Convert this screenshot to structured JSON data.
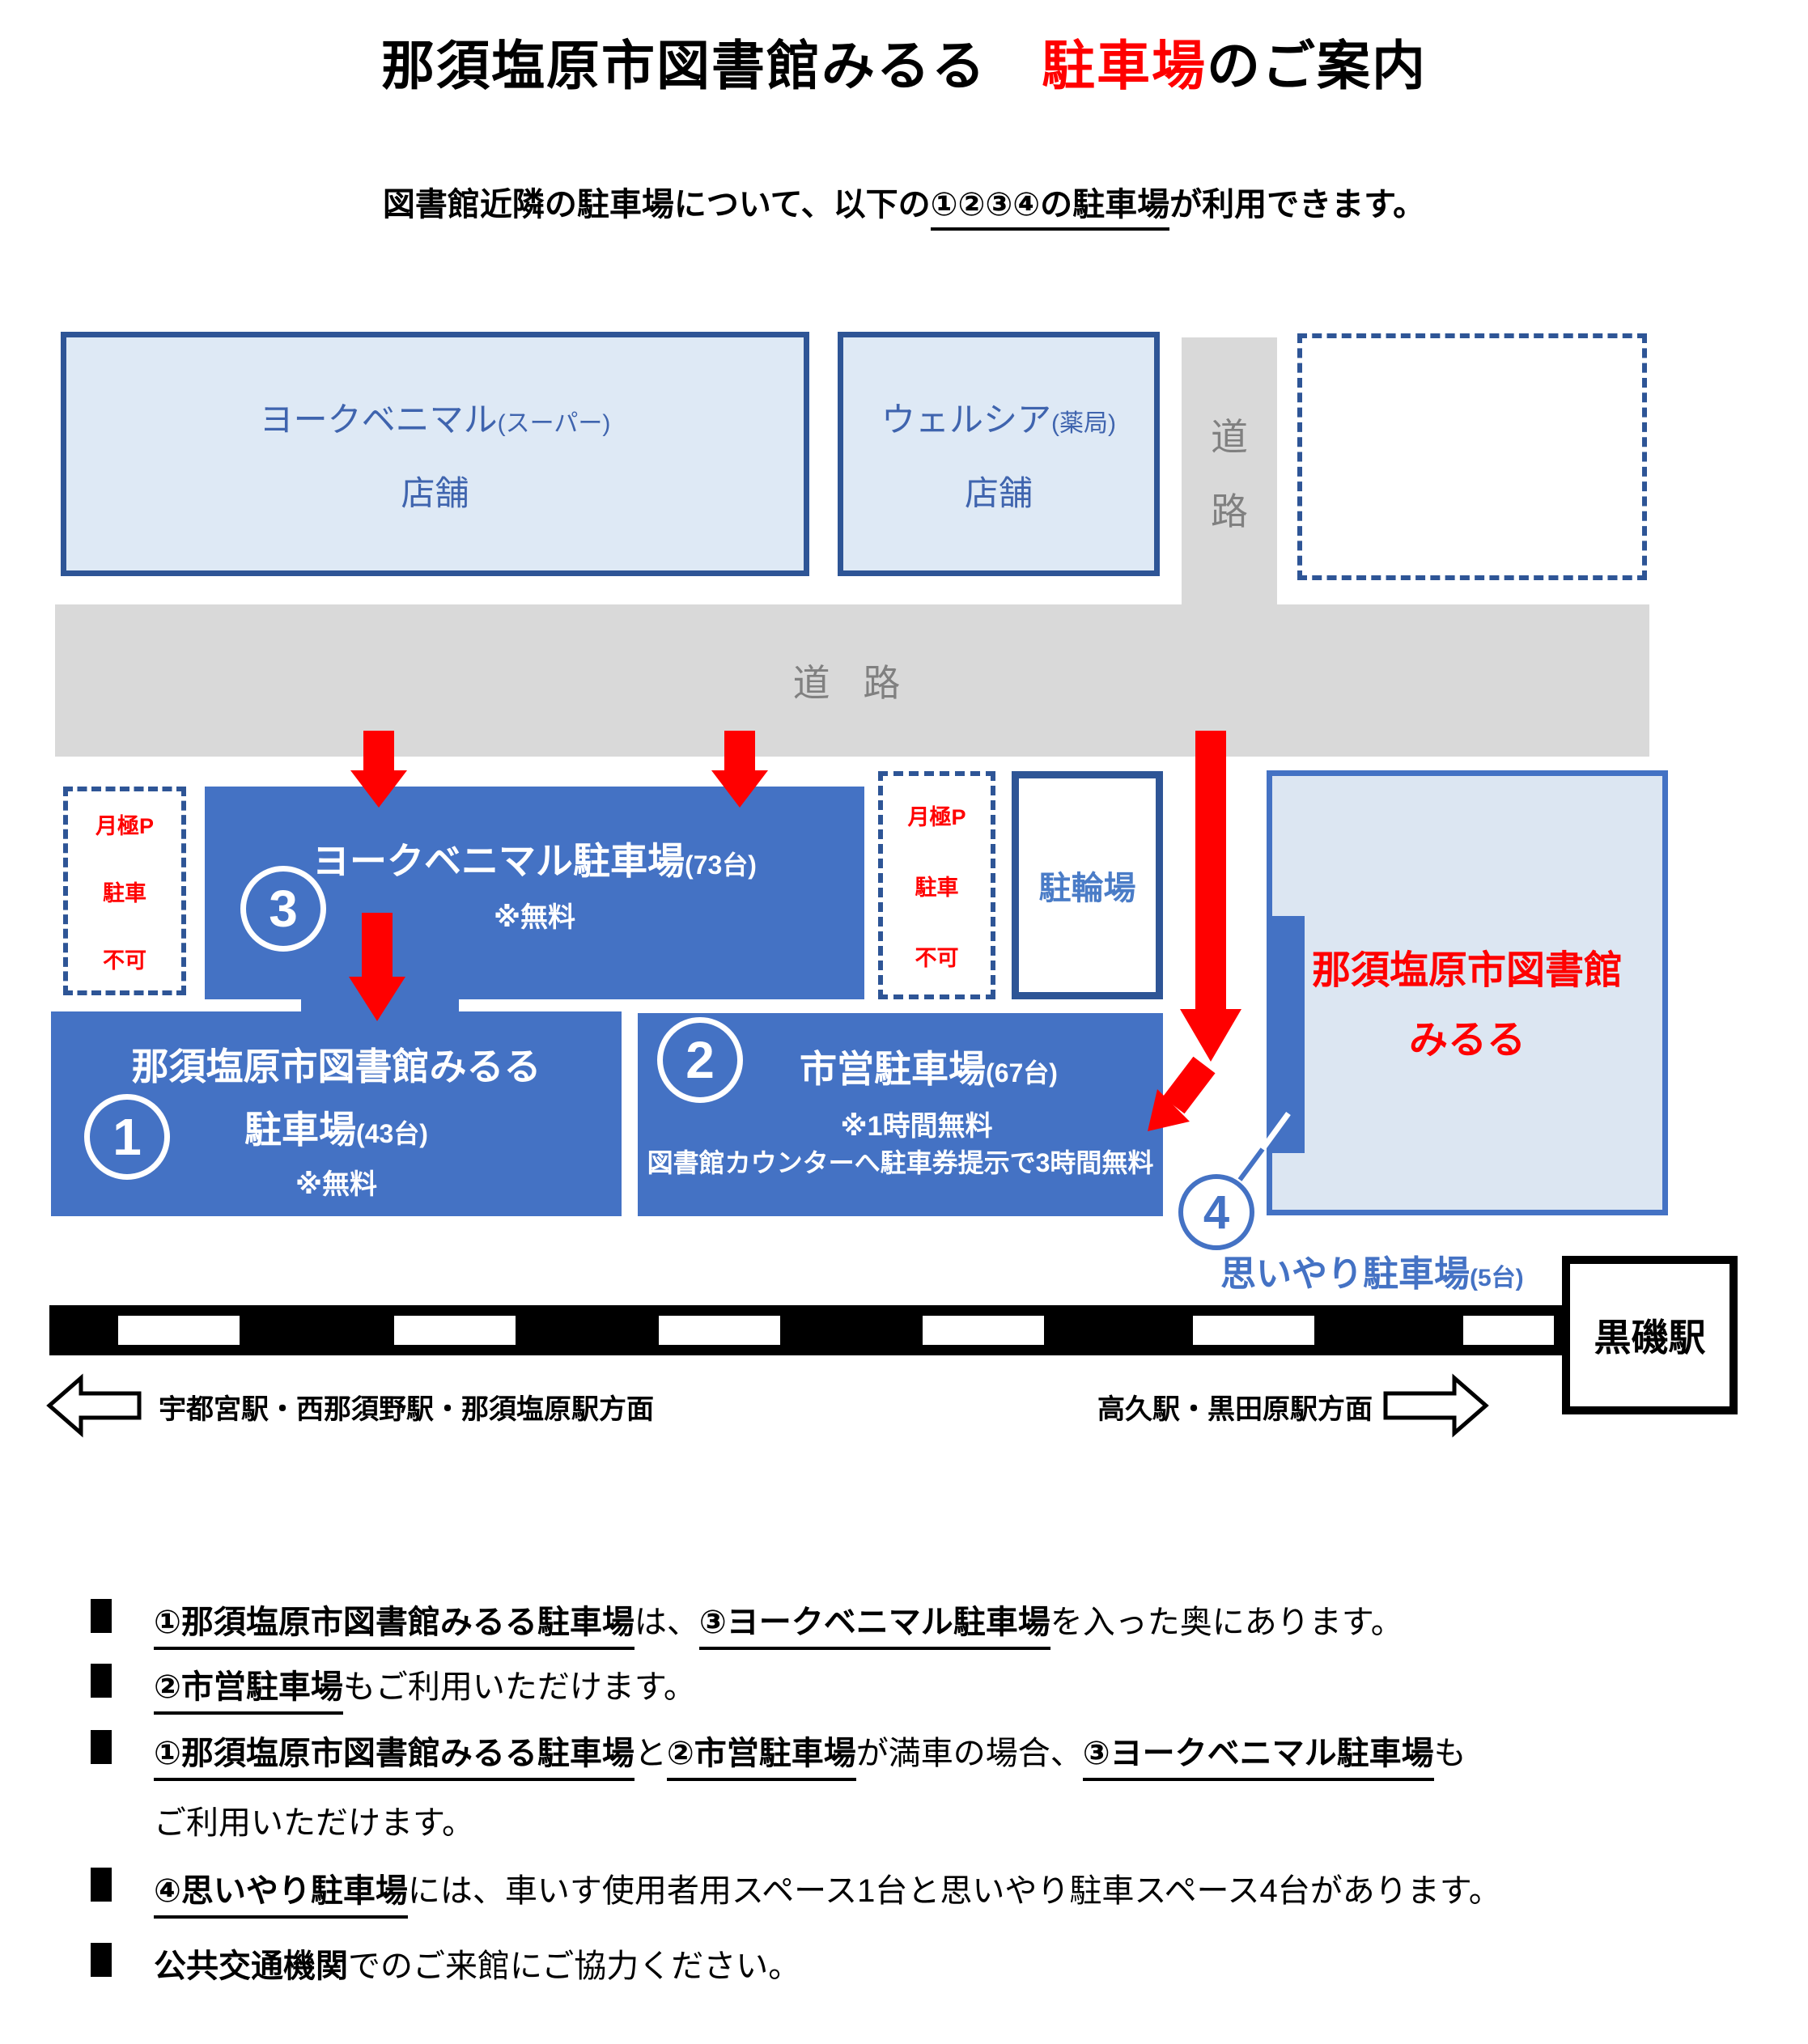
{
  "page": {
    "title_pre": "那須塩原市図書館みるる　",
    "title_highlight": "駐車場",
    "title_post": "のご案内",
    "subtitle_pre": "図書館近隣の駐車場について、以下の",
    "subtitle_underline": "①②③④の駐車場",
    "subtitle_post": "が利用できます。"
  },
  "map": {
    "store_york": {
      "name": "ヨークベニマル",
      "suffix": "(スーパー)",
      "line2": "店舗"
    },
    "store_welcia": {
      "name": "ウェルシア",
      "suffix": "(薬局)",
      "line2": "店舗"
    },
    "road_vertical": {
      "char1": "道",
      "char2": "路"
    },
    "road_horizontal": "道 路",
    "monthly": {
      "line1": "月極P",
      "line2": "駐車",
      "line3": "不可"
    },
    "bicycle_label": "駐輪場",
    "lot3": {
      "num": "3",
      "name": "ヨークベニマル駐車場",
      "cap": "(73台)",
      "note": "※無料"
    },
    "lot1": {
      "num": "1",
      "name_line1": "那須塩原市図書館みるる",
      "name_line2": "駐車場",
      "cap": "(43台)",
      "note": "※無料"
    },
    "lot2": {
      "num": "2",
      "name": "市営駐車場",
      "cap": "(67台)",
      "note1": "※1時間無料",
      "note2": "図書館カウンターへ駐車券提示で3時間無料"
    },
    "library": {
      "line1": "那須塩原市図書館",
      "line2": "みるる"
    },
    "lot4": {
      "num": "4",
      "label": "思いやり駐車場",
      "cap": "(5台)"
    },
    "station_label": "黒磯駅",
    "dir_left": "宇都宮駅・西那須野駅・那須塩原駅方面",
    "dir_right": "高久駅・黒田原駅方面"
  },
  "notes": [
    {
      "marker": true,
      "segments": [
        {
          "t": "①那須塩原市図書館みるる駐車場",
          "b": true,
          "u": true
        },
        {
          "t": "は、"
        },
        {
          "t": "③ヨークベニマル駐車場",
          "b": true,
          "u": true
        },
        {
          "t": "を入った奥にあります。"
        }
      ]
    },
    {
      "marker": true,
      "segments": [
        {
          "t": "②市営駐車場",
          "b": true,
          "u": true
        },
        {
          "t": "もご利用いただけます。"
        }
      ]
    },
    {
      "marker": true,
      "segments": [
        {
          "t": "①那須塩原市図書館みるる駐車場",
          "b": true,
          "u": true
        },
        {
          "t": "と"
        },
        {
          "t": "②市営駐車場",
          "b": true,
          "u": true
        },
        {
          "t": "が満車の場合、"
        },
        {
          "t": "③ヨークベニマル駐車場",
          "b": true,
          "u": true
        },
        {
          "t": "も"
        }
      ]
    },
    {
      "marker": false,
      "segments": [
        {
          "t": "ご利用いただけます。"
        }
      ]
    },
    {
      "marker": true,
      "segments": [
        {
          "t": "④思いやり駐車場",
          "b": true,
          "u": true
        },
        {
          "t": "には、車いす使用者用スペース1台と思いやり駐車スペース4台があります。"
        }
      ]
    },
    {
      "marker": true,
      "segments": [
        {
          "t": "公共交通機関",
          "b": true
        },
        {
          "t": "でのご来館にご協力ください。"
        }
      ]
    }
  ],
  "colors": {
    "accent_blue": "#4472C4",
    "navy": "#2E5596",
    "store_fill": "#DEE9F5",
    "library_fill": "#DCE6F2",
    "road_gray": "#D9D9D9",
    "gray_text": "#808080",
    "red": "#FF0000"
  }
}
